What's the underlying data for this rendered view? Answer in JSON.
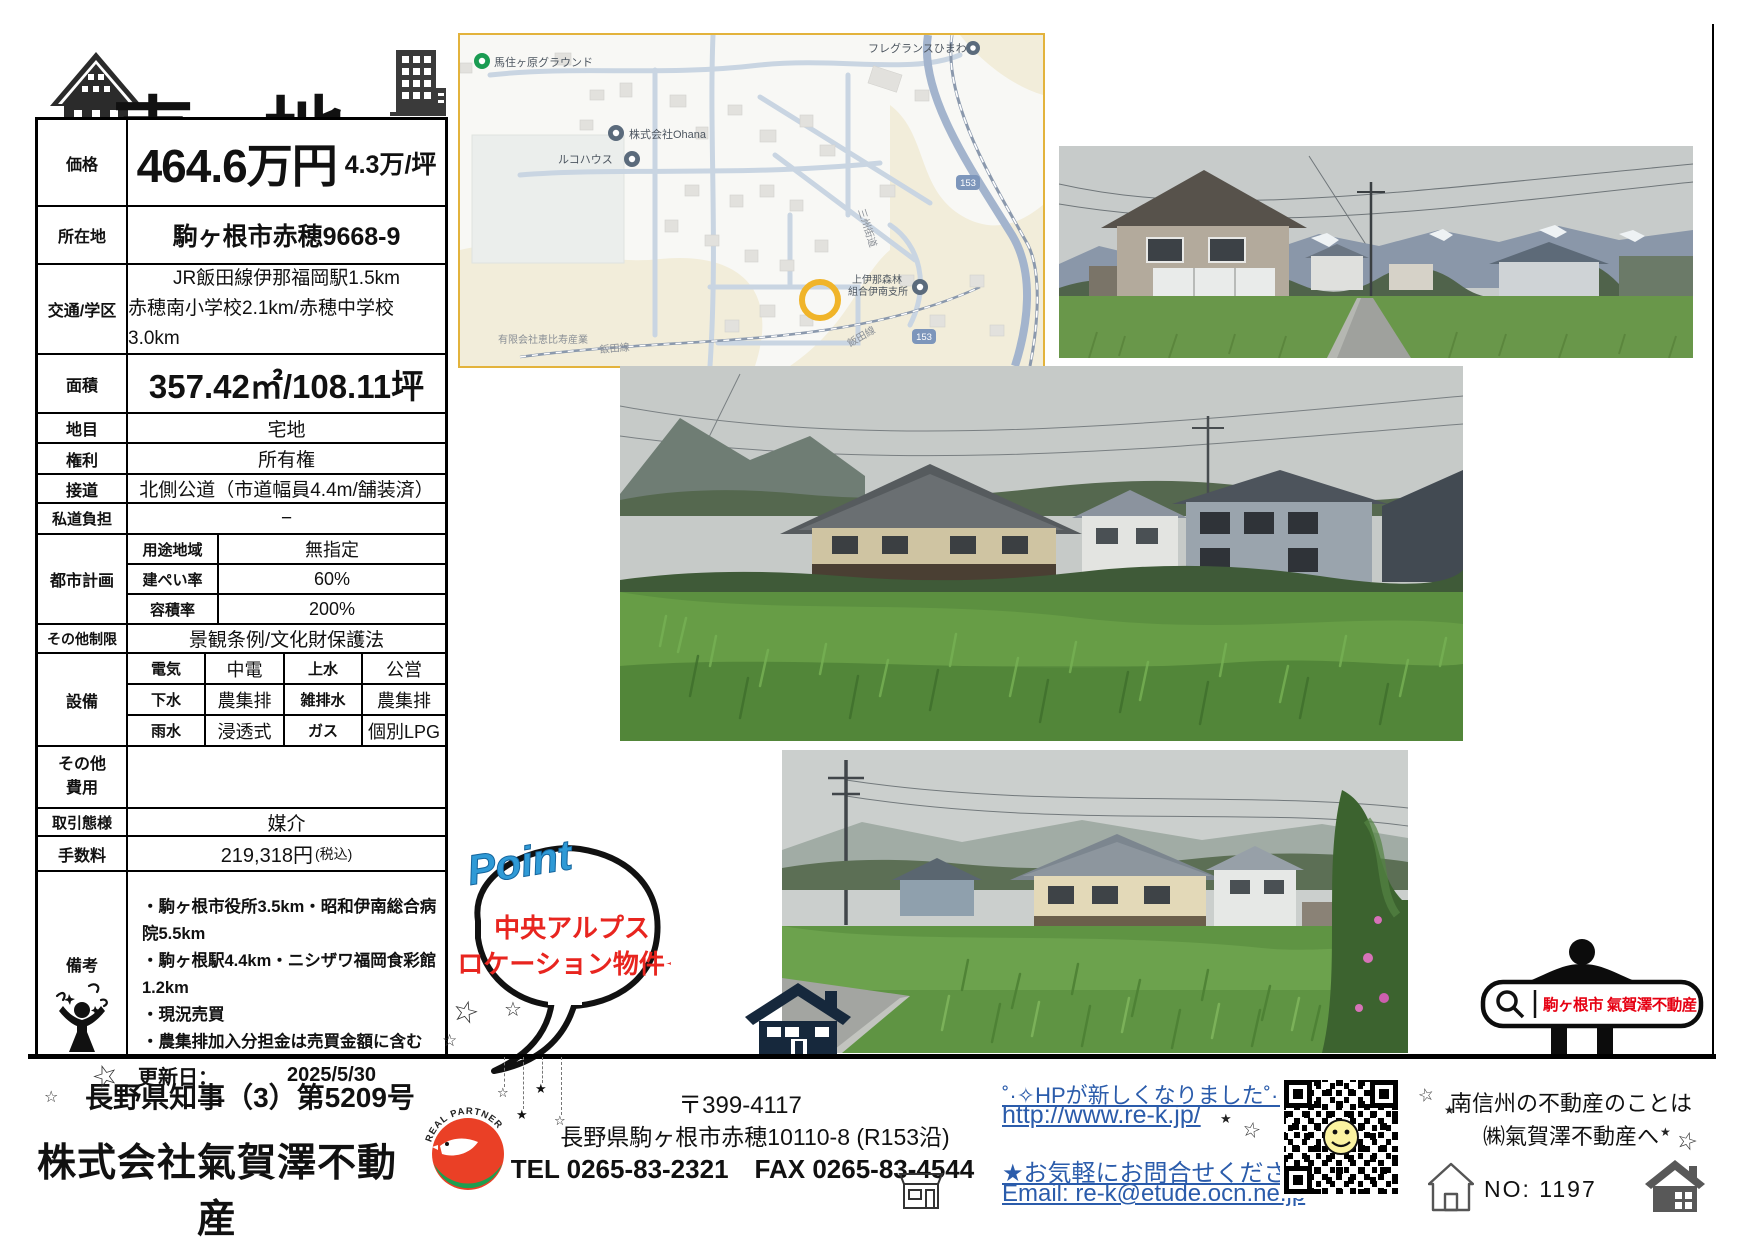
{
  "page": {
    "title": "売地"
  },
  "table": {
    "price": {
      "label": "価格",
      "value": "464.6万円",
      "per_tsubo": "4.3万/坪"
    },
    "location": {
      "label": "所在地",
      "value": "駒ヶ根市赤穂9668-9"
    },
    "access": {
      "label": "交通/学区",
      "line1": "JR飯田線伊那福岡駅1.5km",
      "line2": "赤穂南小学校2.1km/赤穂中学校3.0km"
    },
    "area": {
      "label": "面積",
      "value": "357.42㎡/108.11坪"
    },
    "land_category": {
      "label": "地目",
      "value": "宅地"
    },
    "rights": {
      "label": "権利",
      "value": "所有権"
    },
    "road": {
      "label": "接道",
      "value": "北側公道（市道幅員4.4m/舗装済）"
    },
    "private_road": {
      "label": "私道負担",
      "value": "−"
    },
    "city_planning": {
      "label": "都市計画",
      "sub": [
        {
          "label": "用途地域",
          "value": "無指定"
        },
        {
          "label": "建ぺい率",
          "value": "60%"
        },
        {
          "label": "容積率",
          "value": "200%"
        }
      ]
    },
    "other_restrictions": {
      "label": "その他制限",
      "value": "景観条例/文化財保護法"
    },
    "utilities": {
      "label": "設備",
      "rows": [
        {
          "c1": "電気",
          "v1": "中電",
          "c2": "上水",
          "v2": "公営"
        },
        {
          "c1": "下水",
          "v1": "農集排",
          "c2": "雑排水",
          "v2": "農集排"
        },
        {
          "c1": "雨水",
          "v1": "浸透式",
          "c2": "ガス",
          "v2": "個別LPG"
        }
      ]
    },
    "other_costs": {
      "label1": "その他",
      "label2": "費用",
      "value": ""
    },
    "transaction": {
      "label": "取引態様",
      "value": "媒介"
    },
    "fee": {
      "label": "手数料",
      "value": "219,318円",
      "suffix": "(税込)"
    },
    "remarks": {
      "label": "備考",
      "lines": [
        "・駒ヶ根市役所3.5km・昭和伊南総合病院5.5km",
        "・駒ヶ根駅4.4km・ニシザワ福岡食彩館1.2km",
        "・現況売買",
        "・農集排加入分担金は売買金額に含む"
      ],
      "updated_label": "更新日：",
      "updated_value": "2025/5/30"
    }
  },
  "map": {
    "labels": {
      "ground": "馬住ヶ原グラウンド",
      "ohana": "株式会社Ohana",
      "ruko_house": "ルコハウス",
      "fragrance": "フレグランスひまわり",
      "forest_union_1": "上伊那森林",
      "forest_union_2": "組合伊南支所",
      "ebisu": "有限会社恵比寿産業",
      "sanshu_kaido": "三州街道",
      "iida_line": "飯田線",
      "route_shield": "153"
    }
  },
  "point": {
    "heading": "Point",
    "line1": "中央アルプス",
    "line2": "ロケーション物件✧"
  },
  "search_banner": {
    "query": "駒ヶ根市 氣賀澤不動産"
  },
  "footer": {
    "license": "長野県知事（3）第5209号",
    "company": "株式会社氣賀澤不動産",
    "logo_arc": "REAL PARTNER",
    "postal": "〒399-4117",
    "address": "長野県駒ヶ根市赤穂10110-8 (R153沿)",
    "tel_fax": "TEL 0265-83-2321　FAX 0265-83-4544",
    "hp_note": "˚·✧HPが新しくなりました˚·✧",
    "hp_url": "http://www.re-k.jp/",
    "contact_note": "★お気軽にお問合せください★",
    "contact_email": "Email: re-k@etude.ocn.ne.jp",
    "area_note1": "南信州の不動産のことは",
    "area_note2": "㈱氣賀澤不動産へ",
    "property_no": "NO:  1197"
  },
  "colors": {
    "accent_red": "#e60012",
    "link_blue": "#2b5cab",
    "point_blue": "#2f9ad6",
    "map_marker_yellow": "#f0b429",
    "navy": "#16283c"
  }
}
